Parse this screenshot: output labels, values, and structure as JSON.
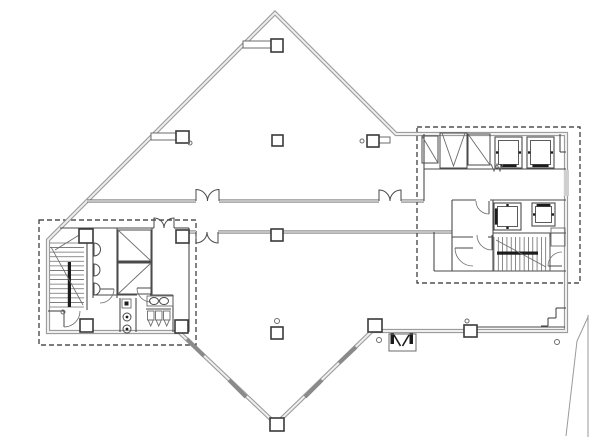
{
  "palette": {
    "exterior_wall": "#9c9c9c",
    "exterior_core": "#efefef",
    "corridor_wall": "#5e5e5e",
    "partition": "#4a4a4a",
    "thin": "#6b6b6b",
    "dark_fill": "#1c1c1c",
    "dashed": "#2f2f2f",
    "tick": "#8a8a8a",
    "site": "#9a9a9a",
    "glass_band": "#cfcfcf",
    "background": "#ffffff"
  },
  "drawing": {
    "width": 600,
    "height": 445,
    "envelope": "M275,13 L396,134 L566,134 L566,331 L372,331 L276,424 L179,332 L48,332 L48,240 Z",
    "dashed_zones": [
      {
        "x": 39,
        "y": 220,
        "w": 157,
        "h": 125
      },
      {
        "x": 417,
        "y": 127,
        "w": 163,
        "h": 156
      }
    ],
    "gray_walls": [
      [
        87,
        201,
        196,
        201
      ],
      [
        219,
        201,
        379,
        201
      ],
      [
        401,
        201,
        424,
        201
      ],
      [
        189,
        232,
        196,
        232
      ],
      [
        218,
        232,
        452,
        232
      ]
    ],
    "partitions": [
      [
        60,
        228,
        154,
        228
      ],
      [
        174,
        228,
        189,
        228
      ],
      [
        189,
        228,
        189,
        332
      ],
      [
        93,
        228,
        93,
        298
      ],
      [
        87,
        242,
        87,
        310
      ],
      [
        117,
        228,
        117,
        298
      ],
      [
        152,
        228,
        152,
        295
      ],
      [
        117,
        262,
        152,
        262
      ],
      [
        93,
        295,
        137,
        295
      ],
      [
        150,
        295,
        173,
        295
      ],
      [
        173,
        295,
        173,
        332
      ],
      [
        120,
        298,
        120,
        332
      ],
      [
        136,
        298,
        136,
        332
      ],
      [
        48,
        311,
        64,
        311
      ],
      [
        146,
        309,
        171,
        309
      ],
      [
        424,
        134,
        424,
        201
      ],
      [
        424,
        169,
        566,
        169
      ],
      [
        560,
        134,
        560,
        152
      ],
      [
        560,
        152,
        566,
        152
      ],
      [
        452,
        200,
        476,
        200
      ],
      [
        490,
        200,
        566,
        200
      ],
      [
        452,
        200,
        452,
        271
      ],
      [
        434,
        232,
        434,
        271
      ],
      [
        434,
        271,
        566,
        271
      ],
      [
        493,
        200,
        493,
        271
      ],
      [
        452,
        237,
        473,
        237
      ],
      [
        488,
        237,
        493,
        237
      ],
      [
        493,
        233,
        566,
        233
      ],
      [
        550,
        233,
        550,
        271
      ],
      [
        473,
        327,
        565,
        327
      ],
      [
        556,
        308,
        566,
        308
      ],
      [
        556,
        308,
        556,
        318
      ],
      [
        548,
        318,
        556,
        318
      ],
      [
        548,
        318,
        548,
        326
      ],
      [
        541,
        326,
        548,
        326
      ]
    ],
    "diag_lines": [
      [
        55,
        250,
        84,
        232
      ]
    ],
    "columns": [
      {
        "x": 271,
        "y": 39,
        "w": 12,
        "h": 13
      },
      {
        "x": 176,
        "y": 131,
        "w": 13,
        "h": 12
      },
      {
        "x": 272,
        "y": 135,
        "w": 11,
        "h": 11
      },
      {
        "x": 367,
        "y": 135,
        "w": 12,
        "h": 12
      },
      {
        "x": 271,
        "y": 229,
        "w": 12,
        "h": 12
      },
      {
        "x": 271,
        "y": 327,
        "w": 12,
        "h": 12
      },
      {
        "x": 270,
        "y": 418,
        "w": 14,
        "h": 13
      },
      {
        "x": 368,
        "y": 319,
        "w": 14,
        "h": 13
      },
      {
        "x": 464,
        "y": 325,
        "w": 13,
        "h": 12
      },
      {
        "x": 79,
        "y": 229,
        "w": 14,
        "h": 14
      },
      {
        "x": 176,
        "y": 230,
        "w": 13,
        "h": 13
      },
      {
        "x": 80,
        "y": 319,
        "w": 13,
        "h": 13
      },
      {
        "x": 175,
        "y": 320,
        "w": 13,
        "h": 13
      }
    ],
    "beams": [
      {
        "x": 243,
        "y": 41,
        "w": 28,
        "h": 7
      },
      {
        "x": 151,
        "y": 133,
        "w": 25,
        "h": 7
      },
      {
        "x": 379,
        "y": 137,
        "w": 11,
        "h": 6
      }
    ],
    "shafts": [
      {
        "x": 422,
        "y": 136,
        "w": 16,
        "h": 27,
        "diag": "bs"
      },
      {
        "x": 440,
        "y": 133,
        "w": 27,
        "h": 35,
        "diag": "v"
      },
      {
        "x": 468,
        "y": 134,
        "w": 22,
        "h": 31,
        "diag": "bs"
      },
      {
        "x": 118,
        "y": 230,
        "w": 33,
        "h": 31,
        "diag": "bs"
      },
      {
        "x": 118,
        "y": 263,
        "w": 33,
        "h": 31,
        "diag": "fs"
      }
    ],
    "elevators": [
      {
        "x": 495,
        "y": 137,
        "w": 27,
        "h": 31,
        "door": "bottom"
      },
      {
        "x": 527,
        "y": 137,
        "w": 27,
        "h": 31,
        "door": "bottom"
      },
      {
        "x": 494,
        "y": 203,
        "w": 27,
        "h": 27,
        "door": "left"
      },
      {
        "x": 532,
        "y": 203,
        "w": 23,
        "h": 23,
        "door": "top"
      }
    ],
    "stairs": [
      {
        "x": 50,
        "y": 243,
        "w": 34,
        "h": 64,
        "dir": "h",
        "n": 14,
        "rail": [
          67.8,
          262,
          3.2,
          45
        ],
        "brk": [
          51,
          247,
          83,
          305
        ]
      },
      {
        "x": 494,
        "y": 237,
        "w": 56,
        "h": 34,
        "dir": "v",
        "n": 13,
        "rail": [
          497,
          251.5,
          41,
          3.2
        ],
        "brk": [
          496,
          240,
          546,
          267
        ]
      }
    ],
    "doors": [
      {
        "c": [
          100,
          289
        ],
        "r": 14,
        "s": [
          114,
          289
        ],
        "e": [
          100,
          303
        ],
        "sw": 1
      },
      {
        "c": [
          151,
          288
        ],
        "r": 14,
        "s": [
          137,
          288
        ],
        "e": [
          151,
          302
        ],
        "sw": 0
      },
      {
        "c": [
          64,
          311
        ],
        "r": 16,
        "s": [
          64,
          327
        ],
        "e": [
          80,
          311
        ],
        "sw": 0
      },
      {
        "c": [
          489,
          201
        ],
        "r": 13,
        "s": [
          489,
          214
        ],
        "e": [
          476,
          201
        ],
        "sw": 1
      },
      {
        "c": [
          492,
          235
        ],
        "r": 15,
        "s": [
          492,
          250
        ],
        "e": [
          477,
          235
        ],
        "sw": 1
      },
      {
        "c": [
          473,
          248
        ],
        "r": 18,
        "s": [
          455,
          248
        ],
        "e": [
          473,
          266
        ],
        "sw": 0
      },
      {
        "c": [
          562,
          266
        ],
        "r": 14,
        "s": [
          548,
          266
        ],
        "e": [
          562,
          252
        ],
        "sw": 1
      }
    ],
    "leaf_doors": [
      {
        "x": 94,
        "y": 243,
        "h": 13
      },
      {
        "x": 94,
        "y": 264,
        "h": 12
      },
      {
        "x": 94,
        "y": 283,
        "h": 12
      }
    ],
    "double_doors": [
      {
        "x1": 196,
        "x2": 219,
        "y": 201,
        "dir": -1
      },
      {
        "x1": 379,
        "x2": 401,
        "y": 201,
        "dir": -1
      },
      {
        "x1": 196,
        "x2": 218,
        "y": 232,
        "dir": 1
      },
      {
        "x1": 154,
        "x2": 174,
        "y": 228,
        "dir": -1
      }
    ],
    "circles": [
      {
        "c": [
          190,
          143
        ],
        "r": 2
      },
      {
        "c": [
          362,
          141
        ],
        "r": 2
      },
      {
        "c": [
          277,
          321
        ],
        "r": 2.5
      },
      {
        "c": [
          379,
          340
        ],
        "r": 2.5
      },
      {
        "c": [
          557,
          342
        ],
        "r": 2.5
      },
      {
        "c": [
          63,
          312
        ],
        "r": 2
      },
      {
        "c": [
          467,
          321
        ],
        "r": 2
      }
    ],
    "drains": [
      {
        "c": [
          127,
          317
        ],
        "r": 4
      },
      {
        "c": [
          127,
          329
        ],
        "r": 4
      }
    ],
    "sinks": [
      {
        "c": [
          154,
          301
        ],
        "rx": 4.5,
        "ry": 3.5
      },
      {
        "c": [
          164,
          301
        ],
        "rx": 4.5,
        "ry": 3.5
      }
    ],
    "urinals": [
      [
        147.5,
        311
      ],
      [
        155.5,
        311
      ],
      [
        163.5,
        311
      ]
    ],
    "thin_rects": [
      {
        "x": 551,
        "y": 228,
        "w": 14,
        "h": 18
      },
      {
        "x": 147,
        "y": 296,
        "w": 26,
        "h": 10
      },
      {
        "x": 122,
        "y": 299,
        "w": 9,
        "h": 9
      }
    ],
    "dark_rects": [
      {
        "x": 124.5,
        "y": 301.5,
        "w": 4,
        "h": 4
      },
      {
        "x": 390.5,
        "y": 333,
        "w": 3.5,
        "h": 11
      },
      {
        "x": 409.5,
        "y": 333,
        "w": 3.5,
        "h": 11
      }
    ],
    "vestibule": {
      "x": 389,
      "y": 334,
      "w": 27,
      "h": 17,
      "leaves": [
        [
          394,
          335,
          400.5,
          346
        ],
        [
          409,
          335,
          402.5,
          346
        ]
      ]
    },
    "window_band": {
      "x": 564,
      "y": 170,
      "w": 5,
      "h": 26
    },
    "wall_ticks": [
      [
        187,
        339,
        204,
        356
      ],
      [
        229,
        380,
        246,
        397
      ],
      [
        356,
        347,
        339,
        363
      ],
      [
        322,
        380,
        305,
        397
      ]
    ],
    "site_lines": [
      [
        588,
        315,
        588,
        437
      ]
    ],
    "polylines": [
      {
        "pts": "588,317 577,341 566,436",
        "style": "site"
      },
      {
        "pts": "491,164 494,171 497,164 500,171 503,164",
        "style": "thin"
      }
    ]
  }
}
